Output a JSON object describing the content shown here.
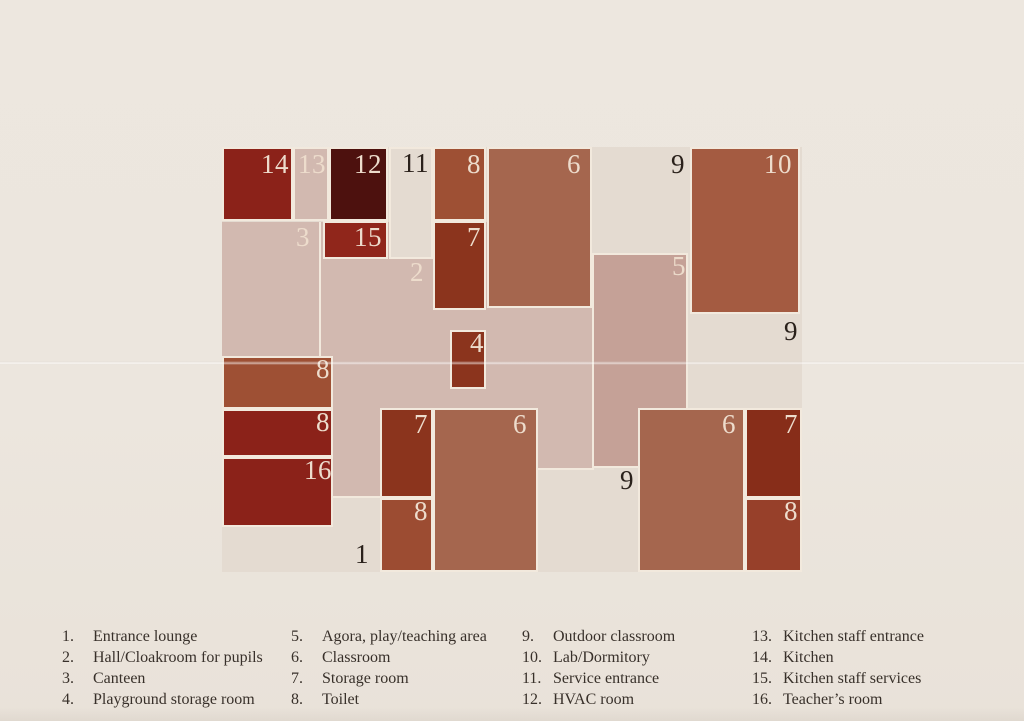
{
  "palette": {
    "page_bg": "#ece6de",
    "plan_base": "#e4dbd1",
    "pink": "#d2b9b0",
    "dusty": "#c5a197",
    "terracotta": "#9e5034",
    "terracotta_light": "#a5664e",
    "terracotta_10": "#a45b41",
    "terracotta_8s": "#9c4c32",
    "terracotta_8e": "#97402a",
    "rust": "#8b341d",
    "red_dark": "#8b2219",
    "red_15": "#90261b",
    "red_7e": "#872d19",
    "maroon": "#4d110e",
    "room_border": "#f2e9dd",
    "label_cream": "#eddccc",
    "label_dark": "#2a211b",
    "legend_text": "#38302a"
  },
  "plan": {
    "zones": [
      {
        "name": "plan-base",
        "x": 222,
        "y": 147,
        "w": 580,
        "h": 425,
        "fill": "plan_base",
        "border": false
      },
      {
        "name": "zone-hall-2-3",
        "x": 222,
        "y": 222,
        "w": 370,
        "h": 248,
        "fill": "pink",
        "border": false
      },
      {
        "name": "zone-hall-extension",
        "x": 333,
        "y": 464,
        "w": 47,
        "h": 34,
        "fill": "pink",
        "border": false
      },
      {
        "name": "zone-corridor-11",
        "x": 389,
        "y": 147,
        "w": 44,
        "h": 112,
        "fill": "plan_base",
        "border": true
      },
      {
        "name": "zone-agora-5",
        "x": 592,
        "y": 253,
        "w": 96,
        "h": 215,
        "fill": "dusty",
        "border": true
      }
    ],
    "lines": [
      {
        "name": "divider-3-2",
        "x": 319,
        "y": 222,
        "w": 2,
        "h": 136
      },
      {
        "name": "hall-bottom-east",
        "x": 538,
        "y": 468,
        "w": 56,
        "h": 2
      },
      {
        "name": "hall-extension-bottom",
        "x": 333,
        "y": 496,
        "w": 47,
        "h": 2
      }
    ],
    "rooms": [
      {
        "id": "14",
        "x": 222,
        "y": 147,
        "w": 71,
        "h": 74,
        "fill": "red_dark"
      },
      {
        "id": "13",
        "x": 293,
        "y": 147,
        "w": 36,
        "h": 74,
        "fill": "pink"
      },
      {
        "id": "12",
        "x": 329,
        "y": 147,
        "w": 59,
        "h": 74,
        "fill": "maroon"
      },
      {
        "id": "8-north",
        "x": 433,
        "y": 147,
        "w": 53,
        "h": 74,
        "fill": "terracotta"
      },
      {
        "id": "6-north",
        "x": 487,
        "y": 147,
        "w": 105,
        "h": 161,
        "fill": "terracotta_light"
      },
      {
        "id": "10",
        "x": 690,
        "y": 147,
        "w": 110,
        "h": 167,
        "fill": "terracotta_10"
      },
      {
        "id": "15",
        "x": 323,
        "y": 221,
        "w": 65,
        "h": 38,
        "fill": "red_15"
      },
      {
        "id": "7-north",
        "x": 433,
        "y": 221,
        "w": 53,
        "h": 89,
        "fill": "rust"
      },
      {
        "id": "4",
        "x": 450,
        "y": 330,
        "w": 36,
        "h": 59,
        "fill": "rust"
      },
      {
        "id": "8-west-a",
        "x": 222,
        "y": 356,
        "w": 111,
        "h": 53,
        "fill": "terracotta"
      },
      {
        "id": "8-west-b",
        "x": 222,
        "y": 409,
        "w": 111,
        "h": 48,
        "fill": "red_dark"
      },
      {
        "id": "16",
        "x": 222,
        "y": 457,
        "w": 111,
        "h": 70,
        "fill": "red_dark"
      },
      {
        "id": "7-south",
        "x": 380,
        "y": 408,
        "w": 53,
        "h": 90,
        "fill": "rust"
      },
      {
        "id": "8-south",
        "x": 380,
        "y": 498,
        "w": 53,
        "h": 74,
        "fill": "terracotta_8s"
      },
      {
        "id": "6-south",
        "x": 433,
        "y": 408,
        "w": 105,
        "h": 164,
        "fill": "terracotta_light"
      },
      {
        "id": "6-east",
        "x": 638,
        "y": 408,
        "w": 107,
        "h": 164,
        "fill": "terracotta_light"
      },
      {
        "id": "7-east",
        "x": 745,
        "y": 408,
        "w": 57,
        "h": 90,
        "fill": "red_7e"
      },
      {
        "id": "8-east",
        "x": 745,
        "y": 498,
        "w": 57,
        "h": 74,
        "fill": "terracotta_8e"
      }
    ],
    "labels": [
      {
        "text": "14",
        "x": 289,
        "y": 150,
        "tone": "cream"
      },
      {
        "text": "13",
        "x": 326,
        "y": 150,
        "tone": "cream"
      },
      {
        "text": "12",
        "x": 382,
        "y": 150,
        "tone": "cream"
      },
      {
        "text": "11",
        "x": 429,
        "y": 149,
        "tone": "dark"
      },
      {
        "text": "8",
        "x": 481,
        "y": 150,
        "tone": "cream"
      },
      {
        "text": "6",
        "x": 581,
        "y": 150,
        "tone": "cream"
      },
      {
        "text": "9",
        "x": 685,
        "y": 150,
        "tone": "dark"
      },
      {
        "text": "10",
        "x": 792,
        "y": 150,
        "tone": "cream"
      },
      {
        "text": "3",
        "x": 310,
        "y": 223,
        "tone": "cream"
      },
      {
        "text": "15",
        "x": 382,
        "y": 223,
        "tone": "cream"
      },
      {
        "text": "7",
        "x": 481,
        "y": 223,
        "tone": "cream"
      },
      {
        "text": "2",
        "x": 424,
        "y": 258,
        "tone": "cream"
      },
      {
        "text": "5",
        "x": 686,
        "y": 252,
        "tone": "cream"
      },
      {
        "text": "4",
        "x": 484,
        "y": 329,
        "tone": "cream"
      },
      {
        "text": "9",
        "x": 798,
        "y": 317,
        "tone": "dark"
      },
      {
        "text": "8",
        "x": 330,
        "y": 355,
        "tone": "cream"
      },
      {
        "text": "8",
        "x": 330,
        "y": 408,
        "tone": "cream"
      },
      {
        "text": "16",
        "x": 332,
        "y": 456,
        "tone": "cream"
      },
      {
        "text": "7",
        "x": 428,
        "y": 410,
        "tone": "cream"
      },
      {
        "text": "8",
        "x": 428,
        "y": 497,
        "tone": "cream"
      },
      {
        "text": "6",
        "x": 527,
        "y": 410,
        "tone": "cream"
      },
      {
        "text": "9",
        "x": 634,
        "y": 466,
        "tone": "dark"
      },
      {
        "text": "6",
        "x": 736,
        "y": 410,
        "tone": "cream"
      },
      {
        "text": "7",
        "x": 798,
        "y": 410,
        "tone": "cream"
      },
      {
        "text": "8",
        "x": 798,
        "y": 497,
        "tone": "cream"
      },
      {
        "text": "1",
        "x": 369,
        "y": 540,
        "tone": "dark"
      }
    ]
  },
  "legend": {
    "top": 626,
    "line_height": 21,
    "columns": [
      {
        "x": 62,
        "items": [
          {
            "num": "1.",
            "label": "Entrance lounge"
          },
          {
            "num": "2.",
            "label": "Hall/Cloakroom for pupils"
          },
          {
            "num": "3.",
            "label": "Canteen"
          },
          {
            "num": "4.",
            "label": "Playground storage room"
          }
        ]
      },
      {
        "x": 291,
        "items": [
          {
            "num": "5.",
            "label": "Agora, play/teaching area"
          },
          {
            "num": "6.",
            "label": "Classroom"
          },
          {
            "num": "7.",
            "label": "Storage room"
          },
          {
            "num": "8.",
            "label": "Toilet"
          }
        ]
      },
      {
        "x": 522,
        "items": [
          {
            "num": "9.",
            "label": "Outdoor classroom"
          },
          {
            "num": "10.",
            "label": "Lab/Dormitory"
          },
          {
            "num": "11.",
            "label": "Service entrance"
          },
          {
            "num": "12.",
            "label": "HVAC room"
          }
        ]
      },
      {
        "x": 752,
        "items": [
          {
            "num": "13.",
            "label": "Kitchen staff entrance"
          },
          {
            "num": "14.",
            "label": "Kitchen"
          },
          {
            "num": "15.",
            "label": "Kitchen staff services"
          },
          {
            "num": "16.",
            "label": "Teacher’s room"
          }
        ]
      }
    ]
  },
  "creases": [
    {
      "y": 361
    }
  ]
}
